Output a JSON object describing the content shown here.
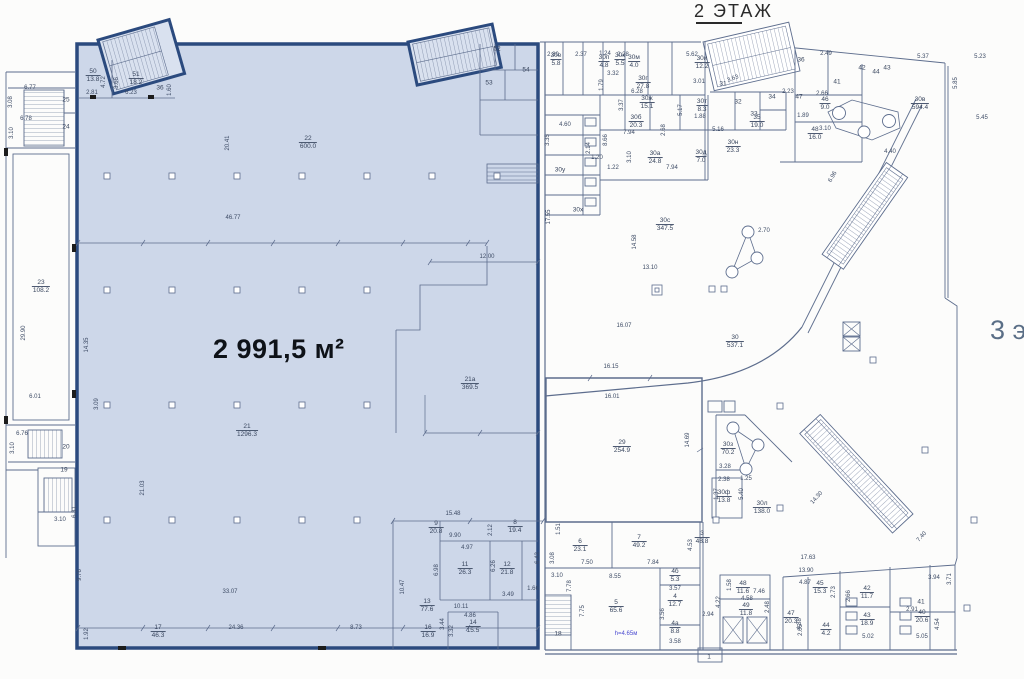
{
  "title": "2 ЭТАЖ",
  "side_label": "3 э",
  "highlight": {
    "area_label": "2 991,5 м²"
  },
  "colors": {
    "highlight_fill": "#cdd7e9",
    "highlight_border": "#2b4a7e",
    "line": "#5d6d8d",
    "dim_text": "#3e4c66",
    "note_text": "#4a4ad0",
    "title_text": "#2a2a2a",
    "side_text": "#5a6e86",
    "big_label_text": "#0e1218"
  },
  "rooms": [
    {
      "n": "25",
      "a": null,
      "x": 66,
      "y": 100
    },
    {
      "n": "24",
      "a": null,
      "x": 66,
      "y": 127
    },
    {
      "n": "23",
      "a": "108.2",
      "x": 41,
      "y": 287
    },
    {
      "n": "20",
      "a": null,
      "x": 66,
      "y": 447
    },
    {
      "n": "19",
      "a": null,
      "x": 64,
      "y": 470
    },
    {
      "n": "36",
      "a": null,
      "x": 160,
      "y": 88
    },
    {
      "n": "50",
      "a": "13.8",
      "x": 93,
      "y": 76
    },
    {
      "n": "51",
      "a": "18.2",
      "x": 136,
      "y": 79
    },
    {
      "n": "52",
      "a": null,
      "x": 497,
      "y": 49
    },
    {
      "n": "53",
      "a": null,
      "x": 489,
      "y": 83
    },
    {
      "n": "54",
      "a": null,
      "x": 526,
      "y": 70
    },
    {
      "n": "22",
      "a": "600.0",
      "x": 308,
      "y": 143
    },
    {
      "n": "21",
      "a": "1296.3",
      "x": 247,
      "y": 431
    },
    {
      "n": "21а",
      "a": "369.5",
      "x": 470,
      "y": 384
    },
    {
      "n": "17",
      "a": "46.3",
      "x": 158,
      "y": 632
    },
    {
      "n": "16",
      "a": "16.9",
      "x": 428,
      "y": 632
    },
    {
      "n": "9",
      "a": "20.8",
      "x": 436,
      "y": 528
    },
    {
      "n": "8",
      "a": "19.4",
      "x": 515,
      "y": 527
    },
    {
      "n": "11",
      "a": "26.3",
      "x": 465,
      "y": 569
    },
    {
      "n": "12",
      "a": "21.8",
      "x": 507,
      "y": 569
    },
    {
      "n": "13",
      "a": "77.6",
      "x": 427,
      "y": 606
    },
    {
      "n": "14",
      "a": "15.5",
      "x": 473,
      "y": 627
    },
    {
      "n": "30е",
      "a": "5.8",
      "x": 556,
      "y": 60
    },
    {
      "n": "30п",
      "a": "4.8",
      "x": 604,
      "y": 62
    },
    {
      "n": "30к",
      "a": "5.5",
      "x": 620,
      "y": 60
    },
    {
      "n": "30м",
      "a": "4.0",
      "x": 634,
      "y": 62
    },
    {
      "n": "30и",
      "a": "12.2",
      "x": 702,
      "y": 63
    },
    {
      "n": "30г",
      "a": "27.8",
      "x": 643,
      "y": 83
    },
    {
      "n": "30ж",
      "a": "15.1",
      "x": 647,
      "y": 103
    },
    {
      "n": "30т",
      "a": "8.3",
      "x": 702,
      "y": 106
    },
    {
      "n": "30б",
      "a": "20.3",
      "x": 636,
      "y": 122
    },
    {
      "n": "31",
      "a": null,
      "x": 723,
      "y": 84
    },
    {
      "n": "32",
      "a": null,
      "x": 738,
      "y": 102
    },
    {
      "n": "33",
      "a": null,
      "x": 754,
      "y": 114
    },
    {
      "n": "34",
      "a": null,
      "x": 772,
      "y": 97
    },
    {
      "n": "35",
      "a": "19.0",
      "x": 757,
      "y": 122
    },
    {
      "n": "30а",
      "a": "24.8",
      "x": 655,
      "y": 158
    },
    {
      "n": "30д",
      "a": "7.0",
      "x": 701,
      "y": 157
    },
    {
      "n": "30н",
      "a": "23.3",
      "x": 733,
      "y": 147
    },
    {
      "n": "30у",
      "a": null,
      "x": 560,
      "y": 170
    },
    {
      "n": "30х",
      "a": null,
      "x": 578,
      "y": 210
    },
    {
      "n": "30с",
      "a": "347.5",
      "x": 665,
      "y": 225
    },
    {
      "n": "30",
      "a": "537.1",
      "x": 735,
      "y": 342
    },
    {
      "n": "30в",
      "a": "594.4",
      "x": 920,
      "y": 104
    },
    {
      "n": "36",
      "a": null,
      "x": 801,
      "y": 60
    },
    {
      "n": "41",
      "a": null,
      "x": 837,
      "y": 82
    },
    {
      "n": "42",
      "a": null,
      "x": 862,
      "y": 68
    },
    {
      "n": "44",
      "a": null,
      "x": 876,
      "y": 72
    },
    {
      "n": "43",
      "a": null,
      "x": 887,
      "y": 68
    },
    {
      "n": "47",
      "a": null,
      "x": 799,
      "y": 97
    },
    {
      "n": "46",
      "a": "9.0",
      "x": 825,
      "y": 104
    },
    {
      "n": "48",
      "a": "16.0",
      "x": 815,
      "y": 134
    },
    {
      "n": "29",
      "a": "254.9",
      "x": 622,
      "y": 447
    },
    {
      "n": "30з",
      "a": "70.2",
      "x": 728,
      "y": 449
    },
    {
      "n": "30ф",
      "a": "13.8",
      "x": 724,
      "y": 497
    },
    {
      "n": "30л",
      "a": "138.0",
      "x": 762,
      "y": 508
    },
    {
      "n": "3",
      "a": "48.8",
      "x": 702,
      "y": 538
    },
    {
      "n": "6",
      "a": "23.1",
      "x": 580,
      "y": 546
    },
    {
      "n": "7",
      "a": "49.2",
      "x": 639,
      "y": 542
    },
    {
      "n": "5",
      "a": "65.6",
      "x": 616,
      "y": 607
    },
    {
      "n": "4б",
      "a": "5.3",
      "x": 675,
      "y": 576
    },
    {
      "n": "4",
      "a": "12.7",
      "x": 675,
      "y": 601
    },
    {
      "n": "4а",
      "a": "8.8",
      "x": 675,
      "y": 628
    },
    {
      "n": "48",
      "a": "11.6",
      "x": 743,
      "y": 588
    },
    {
      "n": "49",
      "a": "11.8",
      "x": 746,
      "y": 610
    },
    {
      "n": "18",
      "a": null,
      "x": 558,
      "y": 634
    },
    {
      "n": "1",
      "a": null,
      "x": 709,
      "y": 657
    },
    {
      "n": "45",
      "a": "15.3",
      "x": 820,
      "y": 588
    },
    {
      "n": "47",
      "a": "20.3",
      "x": 791,
      "y": 618
    },
    {
      "n": "42",
      "a": "11.7",
      "x": 867,
      "y": 593
    },
    {
      "n": "43",
      "a": "18.9",
      "x": 867,
      "y": 620
    },
    {
      "n": "40",
      "a": "20.6",
      "x": 922,
      "y": 617
    },
    {
      "n": "41",
      "a": null,
      "x": 921,
      "y": 602
    },
    {
      "n": "44",
      "a": "4.2",
      "x": 826,
      "y": 630
    }
  ],
  "dims": [
    {
      "t": "20.41",
      "x": 228,
      "y": 143,
      "r": -90
    },
    {
      "t": "46.77",
      "x": 233,
      "y": 218,
      "r": 0
    },
    {
      "t": "12.00",
      "x": 487,
      "y": 257,
      "r": 0
    },
    {
      "t": "14.35",
      "x": 87,
      "y": 345,
      "r": -90
    },
    {
      "t": "3.09",
      "x": 97,
      "y": 404,
      "r": -90
    },
    {
      "t": "6.01",
      "x": 35,
      "y": 397,
      "r": 0
    },
    {
      "t": "21.03",
      "x": 143,
      "y": 488,
      "r": -90
    },
    {
      "t": "33.07",
      "x": 230,
      "y": 592,
      "r": 0
    },
    {
      "t": "24.36",
      "x": 236,
      "y": 628,
      "r": 0
    },
    {
      "t": "8.73",
      "x": 356,
      "y": 628,
      "r": 0
    },
    {
      "t": "1.92",
      "x": 87,
      "y": 634,
      "r": -90
    },
    {
      "t": "9.76",
      "x": 80,
      "y": 575,
      "r": -90
    },
    {
      "t": "2.81",
      "x": 92,
      "y": 93,
      "r": 0
    },
    {
      "t": "6.23",
      "x": 131,
      "y": 93,
      "r": 0
    },
    {
      "t": "4.72",
      "x": 104,
      "y": 82,
      "r": -90
    },
    {
      "t": "3.66",
      "x": 117,
      "y": 83,
      "r": -90
    },
    {
      "t": "1.60",
      "x": 170,
      "y": 90,
      "r": -90
    },
    {
      "t": "15.48",
      "x": 453,
      "y": 514,
      "r": 0
    },
    {
      "t": "9.90",
      "x": 455,
      "y": 536,
      "r": 0
    },
    {
      "t": "4.97",
      "x": 467,
      "y": 548,
      "r": 0
    },
    {
      "t": "6.98",
      "x": 437,
      "y": 570,
      "r": -90
    },
    {
      "t": "6.26",
      "x": 494,
      "y": 566,
      "r": -90
    },
    {
      "t": "10.47",
      "x": 403,
      "y": 587,
      "r": -90
    },
    {
      "t": "10.11",
      "x": 461,
      "y": 607,
      "r": 0
    },
    {
      "t": "4.86",
      "x": 470,
      "y": 616,
      "r": 0
    },
    {
      "t": "3.44",
      "x": 443,
      "y": 624,
      "r": -90
    },
    {
      "t": "3.32",
      "x": 452,
      "y": 631,
      "r": -90
    },
    {
      "t": "3.49",
      "x": 508,
      "y": 595,
      "r": 0
    },
    {
      "t": "1.66",
      "x": 533,
      "y": 589,
      "r": 0
    },
    {
      "t": "6.43",
      "x": 538,
      "y": 558,
      "r": -90
    },
    {
      "t": "2.12",
      "x": 491,
      "y": 530,
      "r": -90
    },
    {
      "t": "6.77",
      "x": 30,
      "y": 88,
      "r": 0
    },
    {
      "t": "3.08",
      "x": 11,
      "y": 102,
      "r": -90
    },
    {
      "t": "6.78",
      "x": 26,
      "y": 119,
      "r": 0
    },
    {
      "t": "3.10",
      "x": 12,
      "y": 133,
      "r": -90
    },
    {
      "t": "29.90",
      "x": 24,
      "y": 333,
      "r": -90
    },
    {
      "t": "6.76",
      "x": 22,
      "y": 434,
      "r": 0
    },
    {
      "t": "3.10",
      "x": 13,
      "y": 448,
      "r": -90
    },
    {
      "t": "3.10",
      "x": 60,
      "y": 520,
      "r": 0
    },
    {
      "t": "6.31",
      "x": 75,
      "y": 512,
      "r": -90
    },
    {
      "t": "5.62",
      "x": 692,
      "y": 55,
      "r": 0
    },
    {
      "t": "2.80",
      "x": 553,
      "y": 55,
      "r": 0
    },
    {
      "t": "2.37",
      "x": 581,
      "y": 55,
      "r": 0
    },
    {
      "t": "1.24",
      "x": 605,
      "y": 54,
      "r": 0
    },
    {
      "t": "2.28",
      "x": 623,
      "y": 55,
      "r": 0
    },
    {
      "t": "2.49",
      "x": 826,
      "y": 54,
      "r": 0
    },
    {
      "t": "5.37",
      "x": 923,
      "y": 57,
      "r": 0
    },
    {
      "t": "5.23",
      "x": 980,
      "y": 57,
      "r": 0
    },
    {
      "t": "5.85",
      "x": 956,
      "y": 83,
      "r": -90
    },
    {
      "t": "5.45",
      "x": 982,
      "y": 118,
      "r": 0
    },
    {
      "t": "3.10",
      "x": 825,
      "y": 129,
      "r": 0
    },
    {
      "t": "4.40",
      "x": 890,
      "y": 152,
      "r": 0
    },
    {
      "t": "6.96",
      "x": 833,
      "y": 177,
      "r": -60
    },
    {
      "t": "2.23",
      "x": 788,
      "y": 92,
      "r": 0
    },
    {
      "t": "2.66",
      "x": 822,
      "y": 94,
      "r": 0
    },
    {
      "t": "1.89",
      "x": 803,
      "y": 116,
      "r": 0
    },
    {
      "t": "3.32",
      "x": 613,
      "y": 74,
      "r": 0
    },
    {
      "t": "1.79",
      "x": 602,
      "y": 85,
      "r": -90
    },
    {
      "t": "6.28",
      "x": 637,
      "y": 92,
      "r": 0
    },
    {
      "t": "3.37",
      "x": 622,
      "y": 105,
      "r": -90
    },
    {
      "t": "5.17",
      "x": 681,
      "y": 110,
      "r": -90
    },
    {
      "t": "7.94",
      "x": 629,
      "y": 133,
      "r": 0
    },
    {
      "t": "2.68",
      "x": 664,
      "y": 130,
      "r": -90
    },
    {
      "t": "3.10",
      "x": 630,
      "y": 157,
      "r": -90
    },
    {
      "t": "1.22",
      "x": 613,
      "y": 168,
      "r": 0
    },
    {
      "t": "1.20",
      "x": 597,
      "y": 158,
      "r": 0
    },
    {
      "t": "8.66",
      "x": 606,
      "y": 140,
      "r": -90
    },
    {
      "t": "2.14",
      "x": 589,
      "y": 148,
      "r": -90
    },
    {
      "t": "4.60",
      "x": 565,
      "y": 125,
      "r": 0
    },
    {
      "t": "3.35",
      "x": 548,
      "y": 140,
      "r": -90
    },
    {
      "t": "1.88",
      "x": 700,
      "y": 117,
      "r": 0
    },
    {
      "t": "5.16",
      "x": 718,
      "y": 130,
      "r": 0
    },
    {
      "t": "3.01",
      "x": 699,
      "y": 82,
      "r": 0
    },
    {
      "t": "3.63",
      "x": 733,
      "y": 79,
      "r": -20
    },
    {
      "t": "7.94",
      "x": 672,
      "y": 168,
      "r": 0
    },
    {
      "t": "17.55",
      "x": 549,
      "y": 217,
      "r": -90
    },
    {
      "t": "14.58",
      "x": 635,
      "y": 242,
      "r": -90
    },
    {
      "t": "13.10",
      "x": 650,
      "y": 268,
      "r": 0
    },
    {
      "t": "16.07",
      "x": 624,
      "y": 326,
      "r": 0
    },
    {
      "t": "2.70",
      "x": 764,
      "y": 231,
      "r": 0
    },
    {
      "t": "16.15",
      "x": 611,
      "y": 367,
      "r": 0
    },
    {
      "t": "16.01",
      "x": 612,
      "y": 397,
      "r": 0
    },
    {
      "t": "14.69",
      "x": 688,
      "y": 440,
      "r": -90
    },
    {
      "t": "3.28",
      "x": 725,
      "y": 467,
      "r": 0
    },
    {
      "t": "2.38",
      "x": 724,
      "y": 480,
      "r": 0
    },
    {
      "t": "1.25",
      "x": 746,
      "y": 479,
      "r": 0
    },
    {
      "t": "5.40",
      "x": 742,
      "y": 494,
      "r": -90
    },
    {
      "t": "1.37",
      "x": 717,
      "y": 494,
      "r": -90
    },
    {
      "t": "1.51",
      "x": 559,
      "y": 529,
      "r": -90
    },
    {
      "t": "14.30",
      "x": 817,
      "y": 498,
      "r": -48
    },
    {
      "t": "7.40",
      "x": 922,
      "y": 537,
      "r": -48
    },
    {
      "t": "17.63",
      "x": 808,
      "y": 558,
      "r": 0
    },
    {
      "t": "13.90",
      "x": 806,
      "y": 571,
      "r": 0
    },
    {
      "t": "3.71",
      "x": 950,
      "y": 579,
      "r": -90
    },
    {
      "t": "4.87",
      "x": 805,
      "y": 583,
      "r": 0
    },
    {
      "t": "2.91",
      "x": 912,
      "y": 610,
      "r": 0
    },
    {
      "t": "5.02",
      "x": 868,
      "y": 637,
      "r": 0
    },
    {
      "t": "5.05",
      "x": 922,
      "y": 637,
      "r": 0
    },
    {
      "t": "4.54",
      "x": 938,
      "y": 624,
      "r": -90
    },
    {
      "t": "4.88",
      "x": 800,
      "y": 624,
      "r": -90
    },
    {
      "t": "2.73",
      "x": 834,
      "y": 592,
      "r": -90
    },
    {
      "t": "2.66",
      "x": 849,
      "y": 596,
      "r": -90
    },
    {
      "t": "2.05",
      "x": 801,
      "y": 630,
      "r": -90
    },
    {
      "t": "3.94",
      "x": 934,
      "y": 578,
      "r": 0
    },
    {
      "t": "7.50",
      "x": 587,
      "y": 563,
      "r": 0
    },
    {
      "t": "7.84",
      "x": 653,
      "y": 563,
      "r": 0
    },
    {
      "t": "8.55",
      "x": 615,
      "y": 577,
      "r": 0
    },
    {
      "t": "3.57",
      "x": 675,
      "y": 589,
      "r": 0
    },
    {
      "t": "3.56",
      "x": 663,
      "y": 614,
      "r": -90
    },
    {
      "t": "3.58",
      "x": 675,
      "y": 642,
      "r": 0
    },
    {
      "t": "2.94",
      "x": 708,
      "y": 615,
      "r": 0
    },
    {
      "t": "4.22",
      "x": 719,
      "y": 602,
      "r": -90
    },
    {
      "t": "1.58",
      "x": 730,
      "y": 585,
      "r": -90
    },
    {
      "t": "7.46",
      "x": 759,
      "y": 592,
      "r": 0
    },
    {
      "t": "4.58",
      "x": 747,
      "y": 599,
      "r": 0
    },
    {
      "t": "2.48",
      "x": 768,
      "y": 607,
      "r": -90
    },
    {
      "t": "7.75",
      "x": 583,
      "y": 611,
      "r": -90
    },
    {
      "t": "7.78",
      "x": 570,
      "y": 586,
      "r": -90
    },
    {
      "t": "3.10",
      "x": 557,
      "y": 576,
      "r": 0
    },
    {
      "t": "3.08",
      "x": 553,
      "y": 558,
      "r": -90
    },
    {
      "t": "4.53",
      "x": 691,
      "y": 545,
      "r": -90
    }
  ],
  "notes": [
    {
      "t": "h=4.65м",
      "x": 626,
      "y": 634
    }
  ]
}
